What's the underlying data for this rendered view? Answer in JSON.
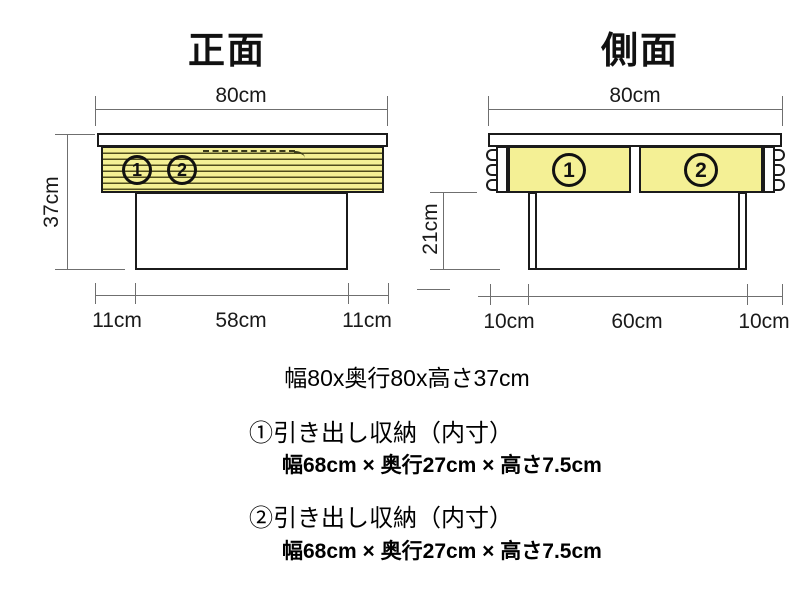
{
  "front_view": {
    "title": "正面",
    "width_label": "80cm",
    "height_label": "37cm",
    "drawer1_num": "1",
    "drawer2_num": "2",
    "bottom_left_label": "11cm",
    "bottom_center_label": "58cm",
    "bottom_right_label": "11cm"
  },
  "side_view": {
    "title": "側面",
    "width_label": "80cm",
    "height_label": "21cm",
    "drawer1_num": "1",
    "drawer2_num": "2",
    "bottom_left_label": "10cm",
    "bottom_center_label": "60cm",
    "bottom_right_label": "10cm"
  },
  "summary": {
    "overall_size": "幅80x奥行80x高さ37cm",
    "item1_heading": "①引き出し収納（内寸）",
    "item1_dims": "幅68cm × 奥行27cm × 高さ7.5cm",
    "item2_heading": "②引き出し収納（内寸）",
    "item2_dims": "幅68cm × 奥行27cm × 高さ7.5cm"
  },
  "colors": {
    "drawer_fill": "#f4f095",
    "outline": "#1b1b1b",
    "dimension_line": "#6f6f6f"
  }
}
